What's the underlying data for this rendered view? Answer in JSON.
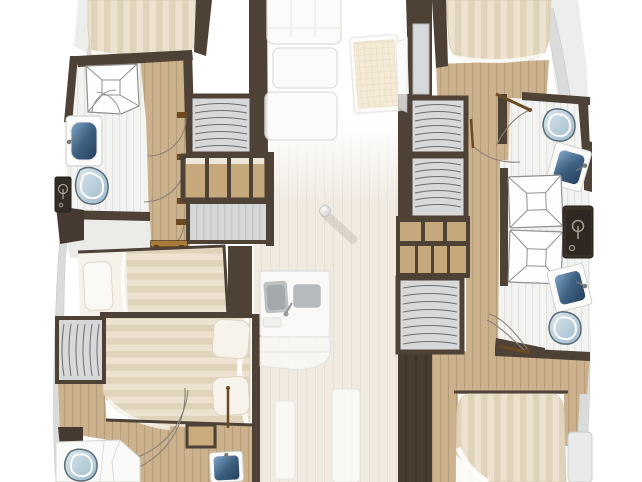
{
  "floorplan": {
    "label": "Catamaran yacht lower-deck interior floor plan, top view, bow at top",
    "port_hull": {
      "forward_head": [
        "shower-stall",
        "washbasin",
        "toilet",
        "shower-mixer"
      ],
      "forward_cabin": [
        "bed",
        "hanging-locker",
        "shelving-unit"
      ],
      "midship_cabin": [
        "companionway-steps",
        "single-berth",
        "double-bed",
        "hanging-locker",
        "nightstand",
        "berth-panel"
      ],
      "aft_head": [
        "toilet",
        "vanity",
        "washbasin",
        "shower-door-arcs"
      ]
    },
    "starboard_hull": {
      "forward_cabin": [
        "bed",
        "hanging-locker",
        "hanging-locker",
        "shelving-unit"
      ],
      "head": [
        "toilet",
        "washbasin",
        "shower-stall",
        "shower-stall",
        "shower-mixer",
        "washbasin",
        "toilet"
      ],
      "aft_cabin": [
        "hanging-locker",
        "bed",
        "side-shelf"
      ]
    },
    "bridge_deck_faded": [
      "saloon-seating",
      "saloon-table",
      "mast-step-ball",
      "galley-double-sink",
      "galley-counter",
      "companionway-strip",
      "companionway-strip"
    ]
  },
  "palette": {
    "background": "#ffffff",
    "wall_brown": "#4e4136",
    "trim_dark": "#3a3128",
    "wood_floor": "#cbb18c",
    "cabinet_wood": "#c6a87d",
    "locker_gray": "#d6d8d9",
    "bathroom_tile": "#f3f3f1",
    "bed_cream": "#ece2cf",
    "bed_stripe": "#e0d3bb",
    "linen_white": "#fafaf8",
    "basin_navy": "#2f4c6b",
    "toilet_blue": "#aec7d8",
    "hull_shell_gray": "#dadcdc",
    "deck_cream": "#f0eae1",
    "door_leaf_brown": "#6b4a23"
  }
}
